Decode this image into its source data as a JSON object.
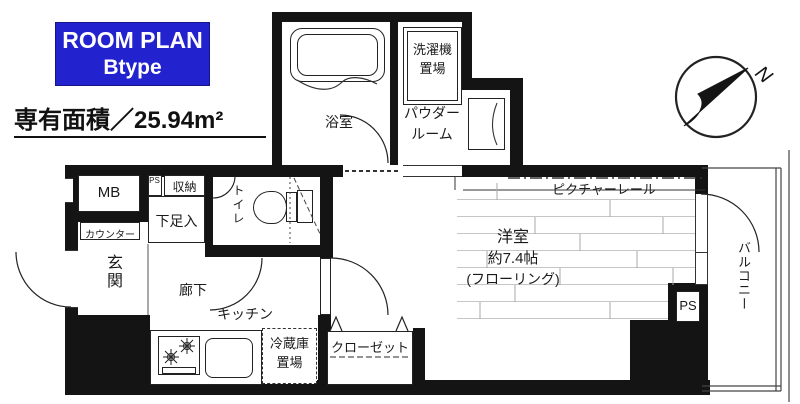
{
  "header": {
    "plan_name": "ROOM PLAN",
    "plan_type": "Btype",
    "area": "専有面積／25.94m²"
  },
  "compass": {
    "north": "N"
  },
  "rooms": {
    "bath": "浴室",
    "laundry": {
      "line1": "洗濯機",
      "line2": "置場"
    },
    "powder": {
      "line1": "パウダー",
      "line2": "ルーム"
    },
    "meter_box": "MB",
    "pipe_space_left": "PS",
    "storage": "収納",
    "shoe_box": "下足入",
    "toilet": "トイレ",
    "counter": "カウンター",
    "entrance": "玄関",
    "hallway": "廊下",
    "kitchen": "キッチン",
    "fridge": {
      "line1": "冷蔵庫",
      "line2": "置場"
    },
    "closet": "クローゼット",
    "western": {
      "line1": "洋室",
      "line2": "約7.4帖",
      "line3": "(フローリング)"
    },
    "picture_rail": "ピクチャーレール",
    "balcony": "バルコニー",
    "pipe_space_right": "PS"
  },
  "colors": {
    "accent_blue": "#2222cf",
    "wall": "#141414"
  }
}
